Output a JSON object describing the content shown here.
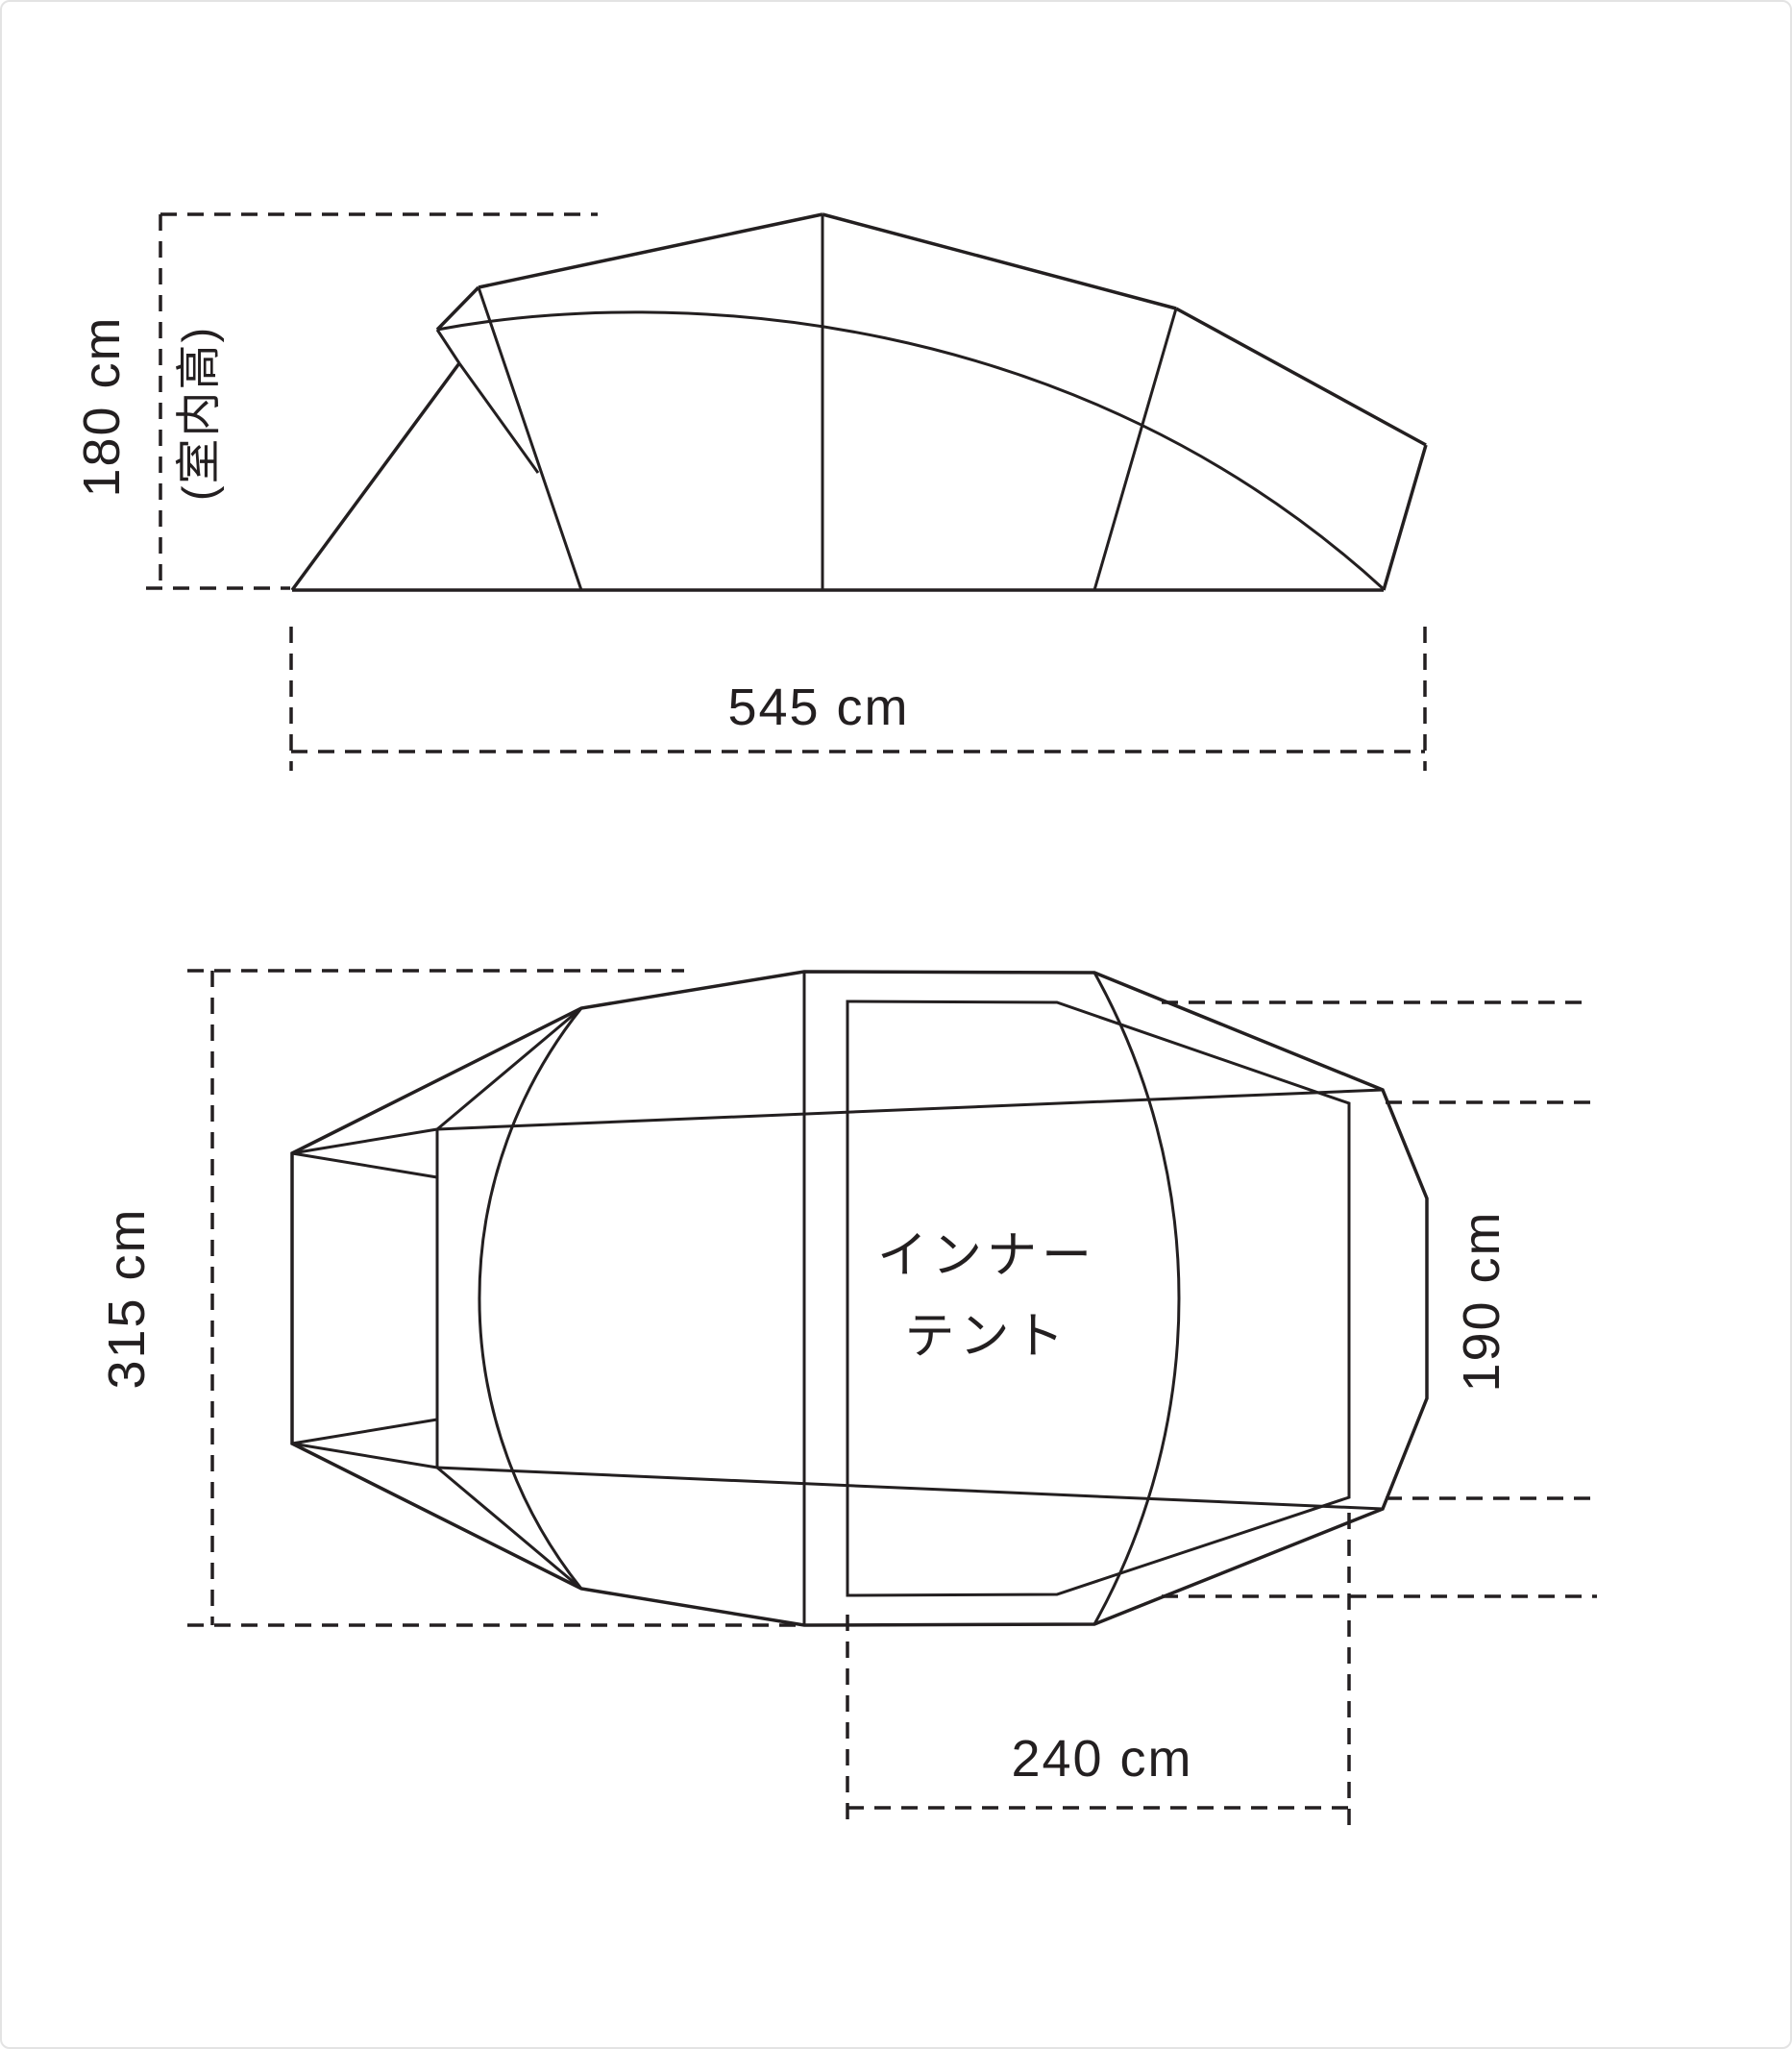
{
  "side_view": {
    "height_value": "180 cm",
    "height_note": "(室内高)",
    "width_value": "545 cm"
  },
  "top_view": {
    "depth_value": "315 cm",
    "inner_depth_value": "190 cm",
    "inner_width_value": "240 cm",
    "inner_tent_label_line1": "インナー",
    "inner_tent_label_line2": "テント"
  },
  "colors": {
    "line": "#231f20",
    "inner_tent_fill": "#c9cacb",
    "background": "#ffffff",
    "frame_border": "#e3e3e3"
  }
}
